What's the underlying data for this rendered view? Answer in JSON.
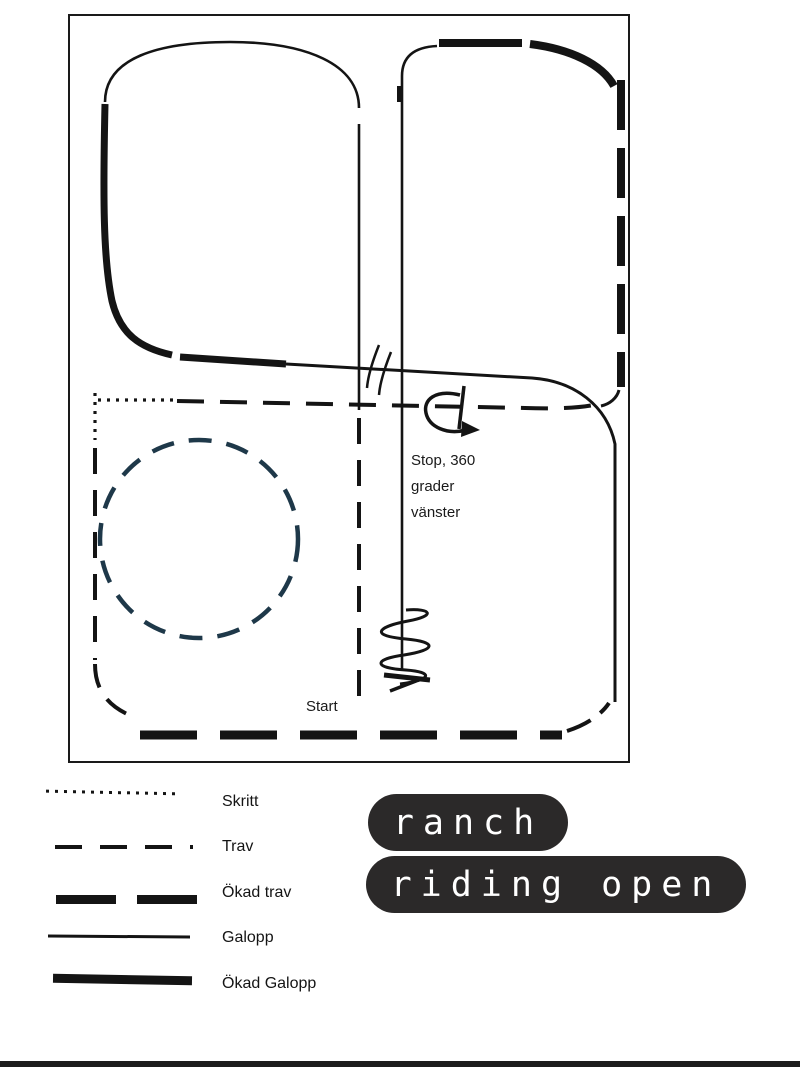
{
  "colors": {
    "line": "#141414",
    "circle_dashed": "#1e3849",
    "badge_background": "#2b2929",
    "badge_text": "#ffffff",
    "bottom_bar": "#1d1d1d"
  },
  "arena": {
    "annotations": {
      "stop_line1": "Stop, 360",
      "stop_line2": "grader",
      "stop_line3": "vänster",
      "start": "Start"
    },
    "shapes": {
      "circle": "dashed-circle-left",
      "backup": "zigzag-backup-mark",
      "turn_arrow": "360-left-turn-arrow",
      "lead_change": "double-slash-marks"
    }
  },
  "legend": {
    "items": [
      {
        "label": "Skritt",
        "style": "dotted"
      },
      {
        "label": "Trav",
        "style": "dashed"
      },
      {
        "label": "Ökad trav",
        "style": "dashed-thick"
      },
      {
        "label": "Galopp",
        "style": "solid"
      },
      {
        "label": "Ökad Galopp",
        "style": "solid-thick"
      }
    ]
  },
  "badges": {
    "line1": "ranch",
    "line2": "riding open"
  }
}
